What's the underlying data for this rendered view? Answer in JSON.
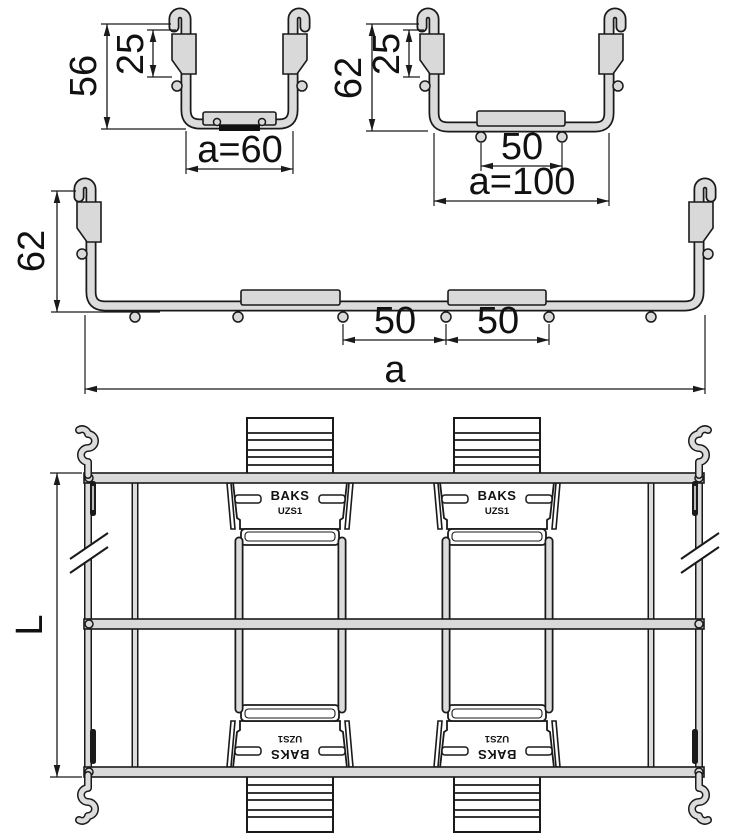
{
  "drawing_title": "Wire mesh cable tray - cross sections and top view",
  "profiles": {
    "small": {
      "height": "56",
      "hook_height": "25",
      "width": "a=60"
    },
    "medium": {
      "height": "62",
      "hook_height": "25",
      "plate_width": "50",
      "width": "a=100"
    },
    "large": {
      "height": "62",
      "gap_width": "50",
      "plate_width": "50",
      "width": "a"
    }
  },
  "top_view": {
    "length": "L",
    "coupler_brand": "BAKS",
    "coupler_model": "UZS1"
  },
  "colors": {
    "outline": "#1a1a1a",
    "wire_fill": "#dcdcdc",
    "plate_fill": "#d9d9d9",
    "background": "#ffffff"
  }
}
